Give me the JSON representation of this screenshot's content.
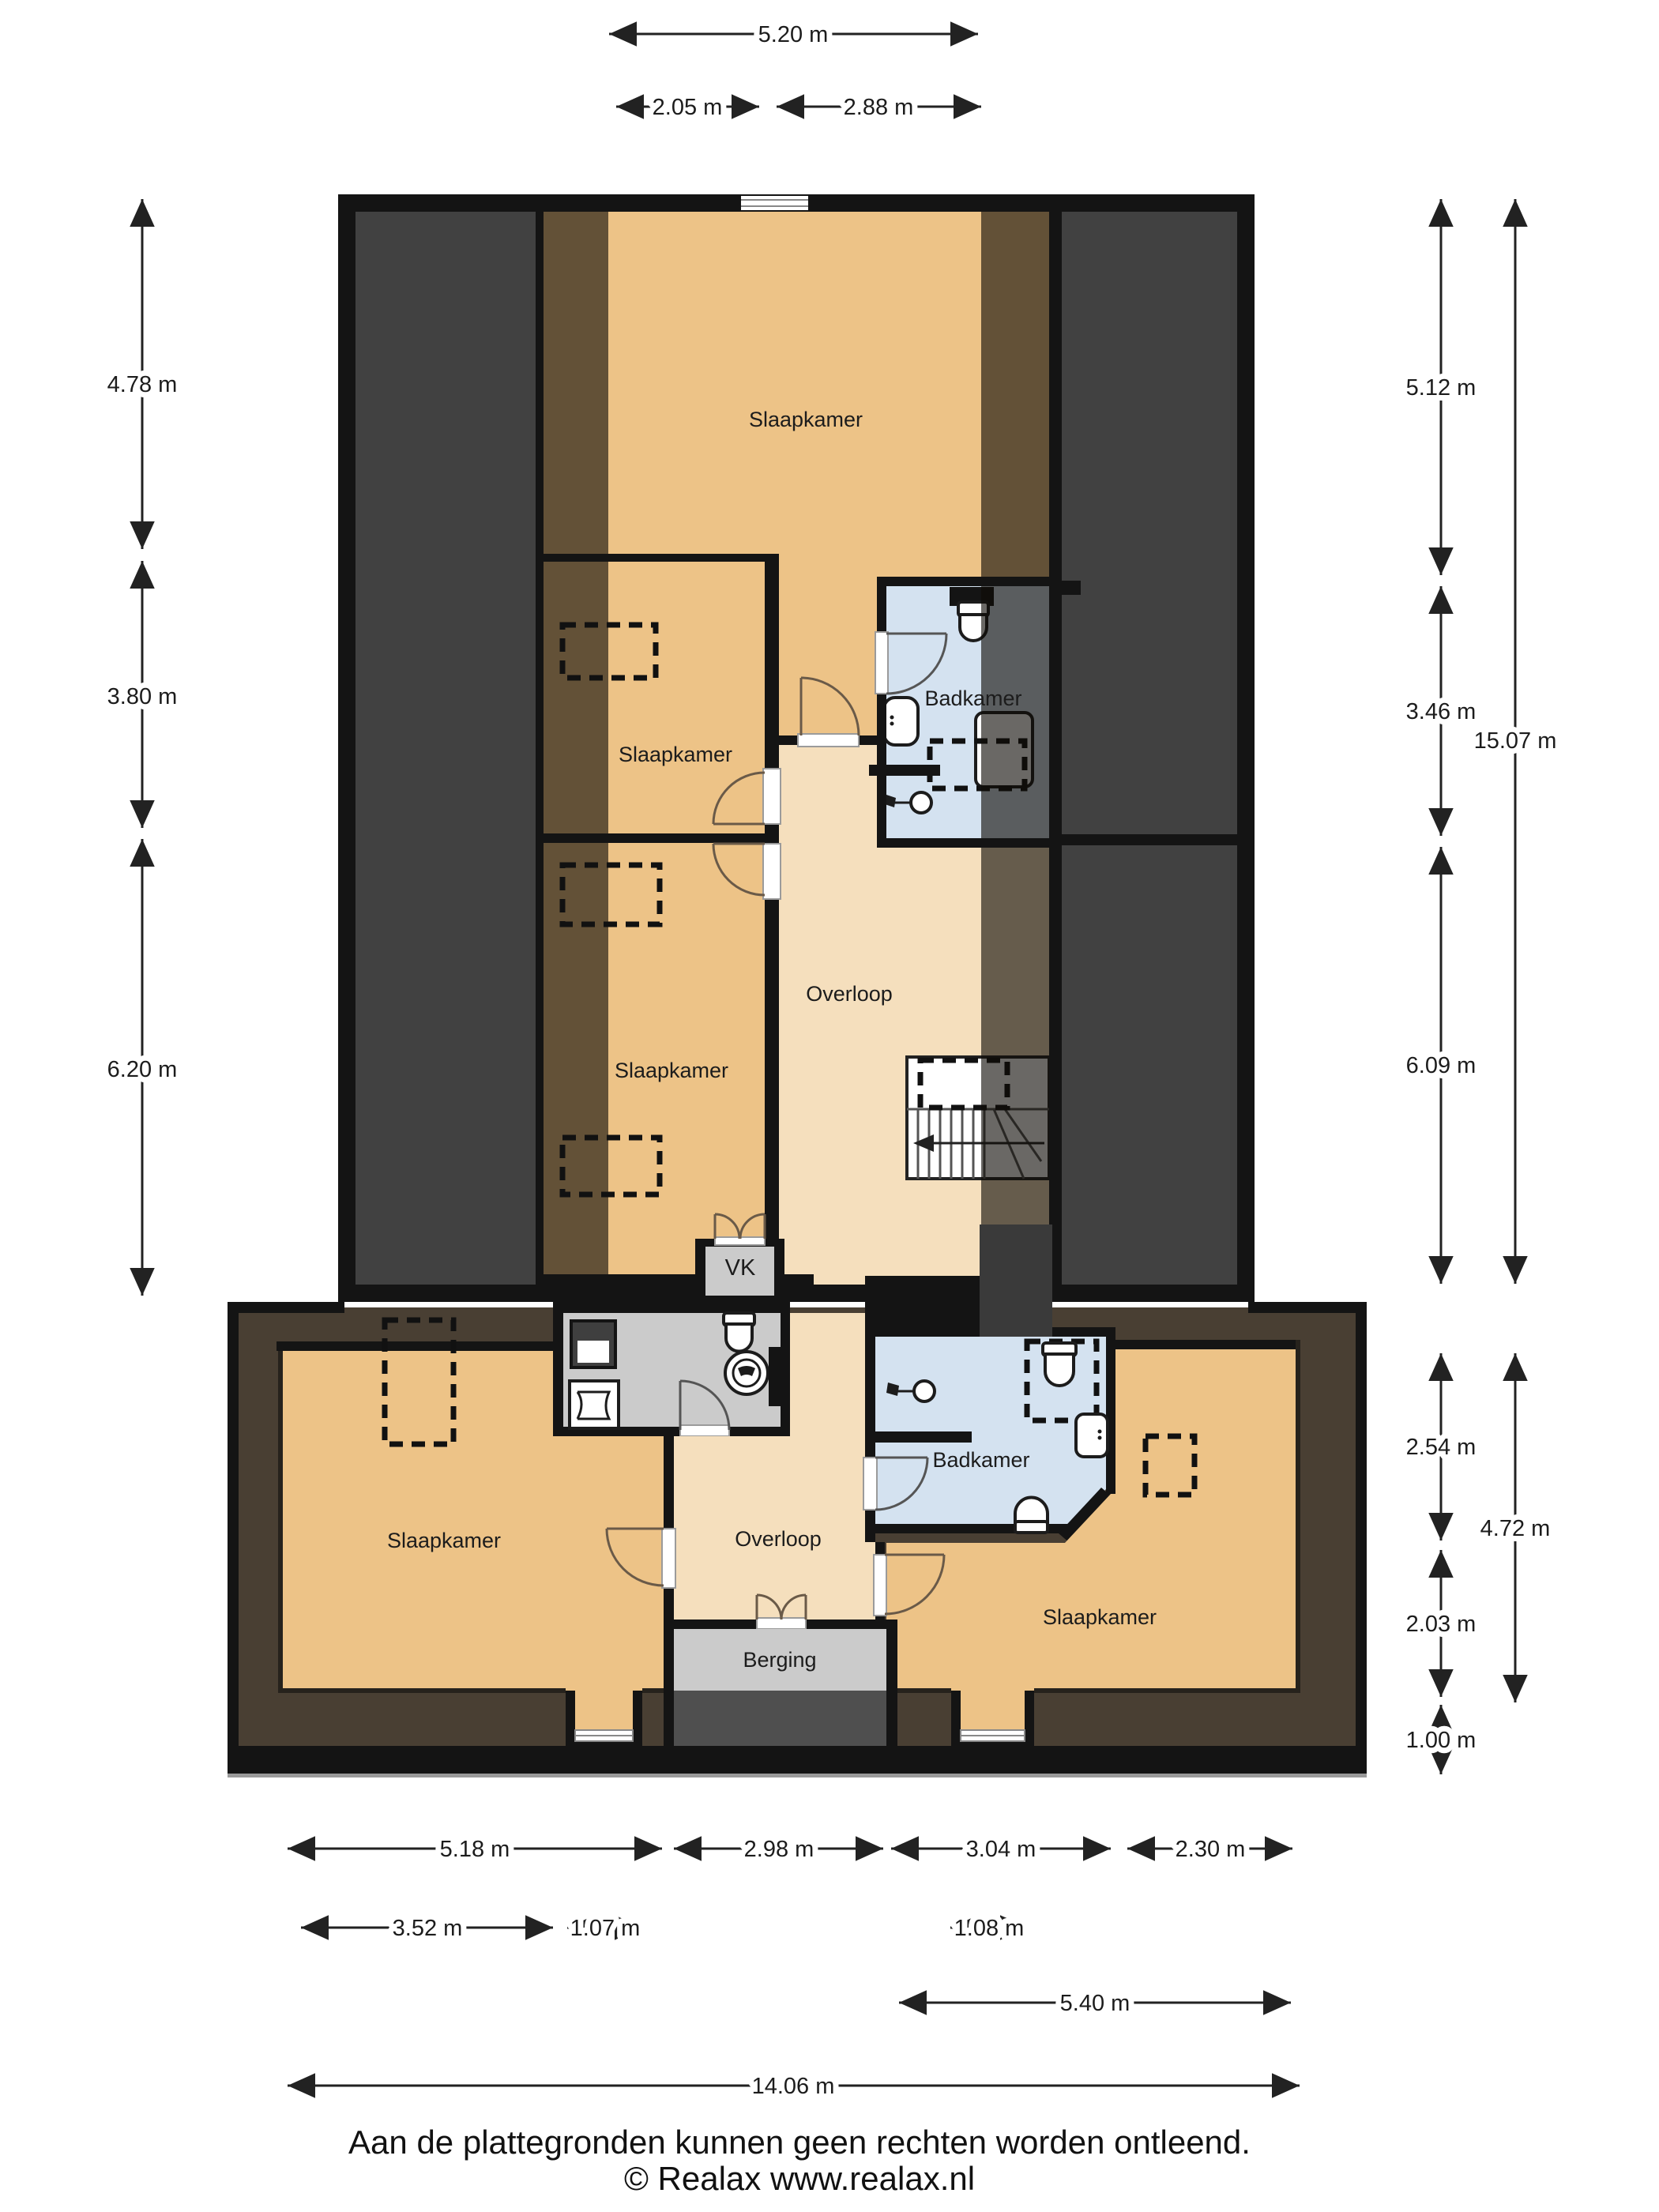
{
  "plan": {
    "rooms": {
      "slaapkamer_top": "Slaapkamer",
      "slaapkamer_mid": "Slaapkamer",
      "slaapkamer_onder": "Slaapkamer",
      "badkamer_boven": "Badkamer",
      "overloop_boven": "Overloop",
      "vk": "VK",
      "slaapkamer_links": "Slaapkamer",
      "overloop_onder": "Overloop",
      "badkamer_onder": "Badkamer",
      "slaapkamer_rechts": "Slaapkamer",
      "berging": "Berging"
    },
    "dimensions": {
      "top": {
        "total": "5.20 m",
        "left": "2.05 m",
        "right": "2.88 m"
      },
      "left": {
        "a": "4.78 m",
        "b": "3.80 m",
        "c": "6.20 m"
      },
      "right": {
        "a": "5.12 m",
        "b": "3.46 m",
        "c": "6.09 m",
        "total_upper": "15.07 m",
        "d": "2.54 m",
        "e": "2.03 m",
        "f": "1.00 m",
        "total_lower": "4.72 m"
      },
      "bottom": {
        "r1a": "5.18 m",
        "r1b": "2.98 m",
        "r1c": "3.04 m",
        "r1d": "2.30 m",
        "r2a": "3.52 m",
        "r2b": "1.07 m",
        "r2c": "1.08 m",
        "r3": "5.40 m",
        "r4": "14.06 m"
      }
    },
    "colors": {
      "wall": "#141414",
      "roof_space": "#414141",
      "room_floor": "#edc387",
      "hall_floor": "#f5dfbd",
      "bathroom_floor": "#d4e2f0",
      "utility_floor": "#cbcbcb",
      "eaves_surround": "#493f33"
    },
    "footer": {
      "disclaimer": "Aan de plattegronden kunnen geen rechten worden ontleend.",
      "copyright": "© Realax www.realax.nl"
    }
  }
}
